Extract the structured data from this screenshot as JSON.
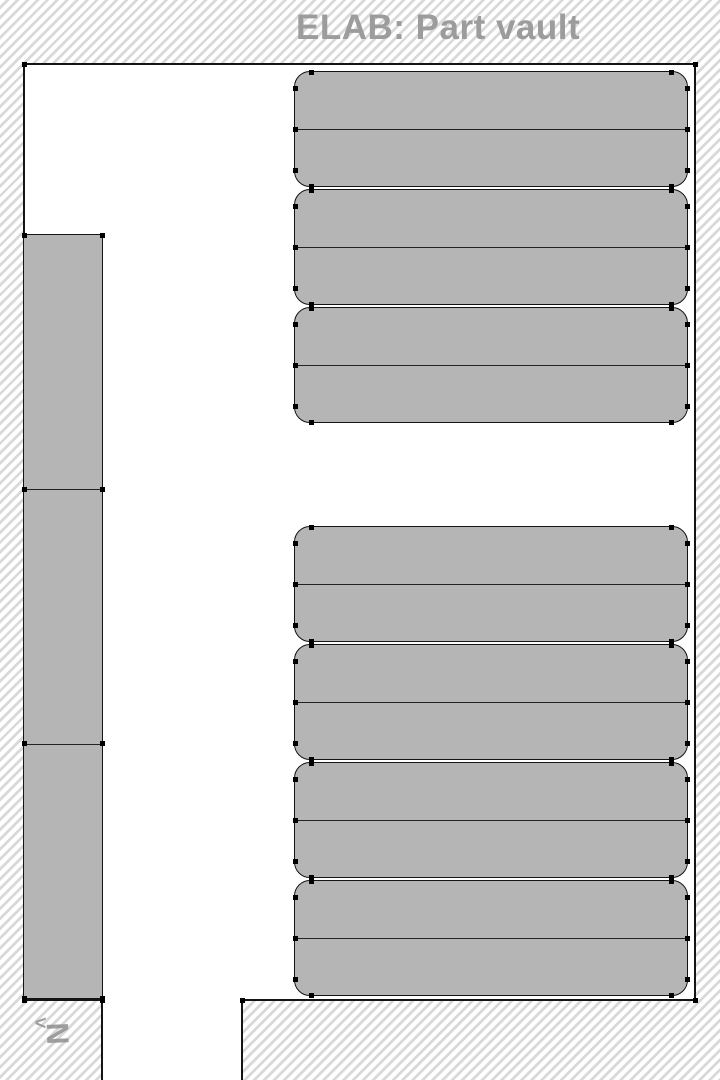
{
  "title": "ELAB: Part vault",
  "compass": {
    "chevron": "<",
    "letter": "N"
  },
  "colors": {
    "hatch_stripe": "#d9d9d9",
    "floor": "#ffffff",
    "wall": "#141414",
    "rack_fill": "#b5b5b5",
    "title_text": "#9c9c9c",
    "compass_text": "#8f8f8f"
  },
  "floorplan": {
    "canvas": {
      "width": 720,
      "height": 1080
    },
    "room": {
      "x": 24,
      "y": 64,
      "width": 671,
      "height": 936
    },
    "corridor_opening": {
      "x": 102,
      "y": 1000,
      "width": 140,
      "height": 80
    },
    "left_rack_column": {
      "x": 24,
      "y": 235,
      "width": 78,
      "height": 763,
      "segments": 3
    },
    "rack_corner_radius": 16,
    "right_rack_x": 295,
    "right_rack_width": 392,
    "right_rack_groups": [
      {
        "name": "top",
        "rack_height": 114,
        "rows_per_rack": 2,
        "y_positions": [
          72,
          190,
          308
        ]
      },
      {
        "name": "bottom",
        "rack_height": 114,
        "rows_per_rack": 2,
        "y_positions": [
          527,
          645,
          763,
          881
        ]
      }
    ]
  }
}
